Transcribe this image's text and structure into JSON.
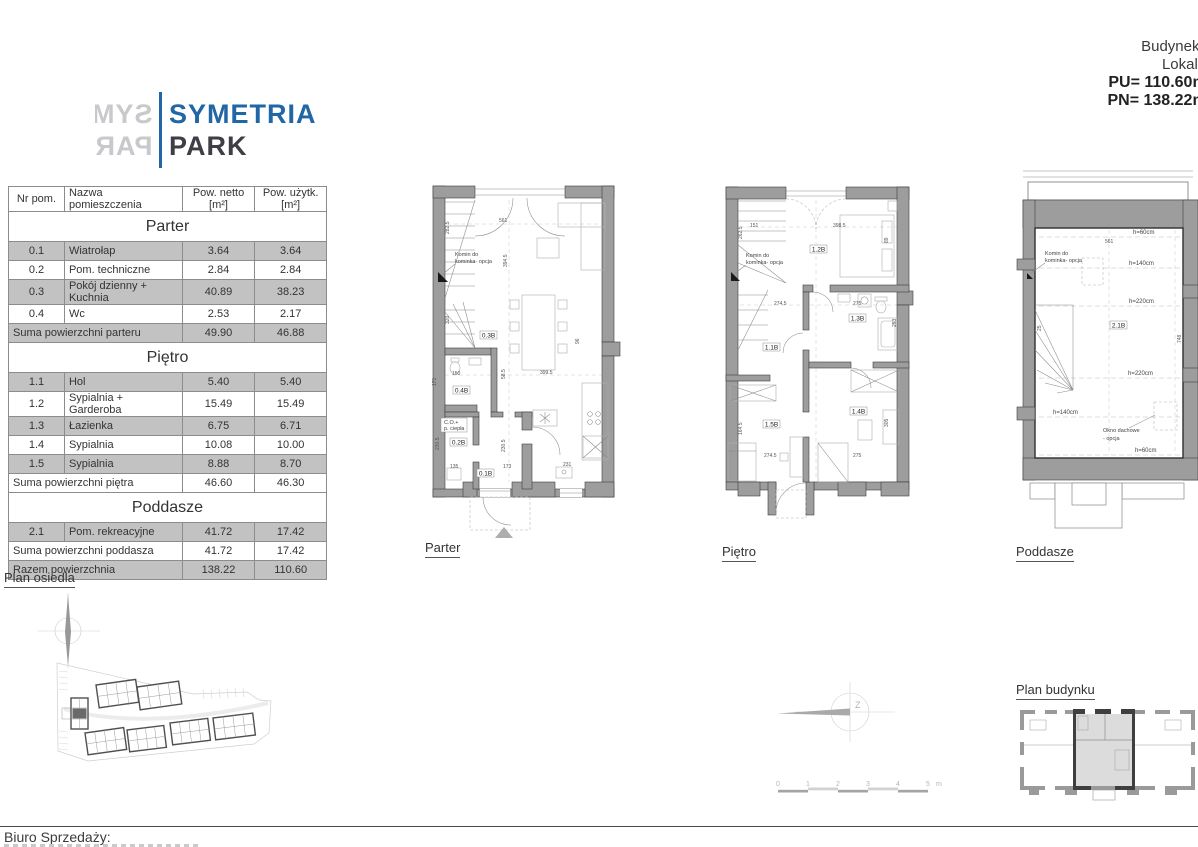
{
  "header": {
    "building": "Budynek 8",
    "unit": "Lokal B",
    "pu": "PU= 110.60m²",
    "pn": "PN= 138.22m²"
  },
  "logo": {
    "name_top": "SYMETRIA",
    "name_bottom": "PARK",
    "blue": "#2166a5",
    "dark": "#3e3e46",
    "mirror_color": "#c9c9cd"
  },
  "table": {
    "columns": [
      "Nr pom.",
      "Nazwa pomieszczenia",
      "Pow. netto [m²]",
      "Pow. użytk. [m²]"
    ],
    "sections": [
      {
        "title": "Parter",
        "rows": [
          [
            "0.1",
            "Wiatrołap",
            "3.64",
            "3.64"
          ],
          [
            "0.2",
            "Pom. techniczne",
            "2.84",
            "2.84"
          ],
          [
            "0.3",
            "Pokój dzienny + Kuchnia",
            "40.89",
            "38.23"
          ],
          [
            "0.4",
            "Wc",
            "2.53",
            "2.17"
          ]
        ],
        "sum": [
          "Suma powierzchni parteru",
          "49.90",
          "46.88"
        ]
      },
      {
        "title": "Piętro",
        "rows": [
          [
            "1.1",
            "Hol",
            "5.40",
            "5.40"
          ],
          [
            "1.2",
            "Sypialnia + Garderoba",
            "15.49",
            "15.49"
          ],
          [
            "1.3",
            "Łazienka",
            "6.75",
            "6.71"
          ],
          [
            "1.4",
            "Sypialnia",
            "10.08",
            "10.00"
          ],
          [
            "1.5",
            "Sypialnia",
            "8.88",
            "8.70"
          ]
        ],
        "sum": [
          "Suma powierzchni piętra",
          "46.60",
          "46.30"
        ]
      },
      {
        "title": "Poddasze",
        "rows": [
          [
            "2.1",
            "Pom. rekreacyjne",
            "41.72",
            "17.42"
          ]
        ],
        "sum": [
          "Suma powierzchni poddasza",
          "41.72",
          "17.42"
        ]
      }
    ],
    "total": [
      "Razem powierzchnia",
      "138.22",
      "110.60"
    ]
  },
  "plan_labels": {
    "parter": "Parter",
    "pietro": "Piętro",
    "poddasze": "Poddasze",
    "osiedle": "Plan osiedla",
    "budynek": "Plan budynku"
  },
  "parter_plan": {
    "rooms": [
      "0.1B",
      "0.2B",
      "0.3B",
      "0.4B"
    ],
    "annotations": {
      "komin_1": "Komin do",
      "komin_2": "kominka- opcja",
      "co_1": "C.O.+",
      "co_2": "p. ciepła"
    },
    "dims": [
      "561",
      "394.5",
      "282.5",
      "320",
      "150",
      "58.5",
      "399.5",
      "135",
      "173",
      "231",
      "230.5",
      "230.5",
      "96",
      "171"
    ]
  },
  "pietro_plan": {
    "rooms": [
      "1.1B",
      "1.2B",
      "1.3B",
      "1.4B",
      "1.5B"
    ],
    "annotations": {
      "komin_1": "Komin do",
      "komin_2": "kominka- opcja"
    },
    "dims": [
      "151",
      "398.5",
      "262.5",
      "89",
      "274.5",
      "275",
      "253",
      "164.5",
      "274.5",
      "275",
      "305"
    ]
  },
  "poddasze_plan": {
    "rooms": [
      "2.1B"
    ],
    "annotations": {
      "komin_1": "Komin do",
      "komin_2": "kominka- opcja",
      "okno_1": "Okno dachowe",
      "okno_2": "- opcja"
    },
    "heights": [
      "h=60cm",
      "h=140cm",
      "h=220cm",
      "h=220cm",
      "h=140cm",
      "h=60cm"
    ],
    "dims": [
      "561",
      "25",
      "748"
    ]
  },
  "scalebar": {
    "ticks": [
      "0",
      "1",
      "2",
      "3",
      "4",
      "5"
    ],
    "unit": "m"
  },
  "compass": {
    "letter": "Z"
  },
  "footer": {
    "office": "Biuro Sprzedaży:"
  },
  "colors": {
    "logo_blue": "#2166a5",
    "logo_dark": "#3e3e46",
    "table_row_gray": "#c2c2c2",
    "wall_gray": "#9d9d9d",
    "highlighted_unit": "#6a6a6a",
    "highlighted_flat": "#dcdcdc"
  }
}
